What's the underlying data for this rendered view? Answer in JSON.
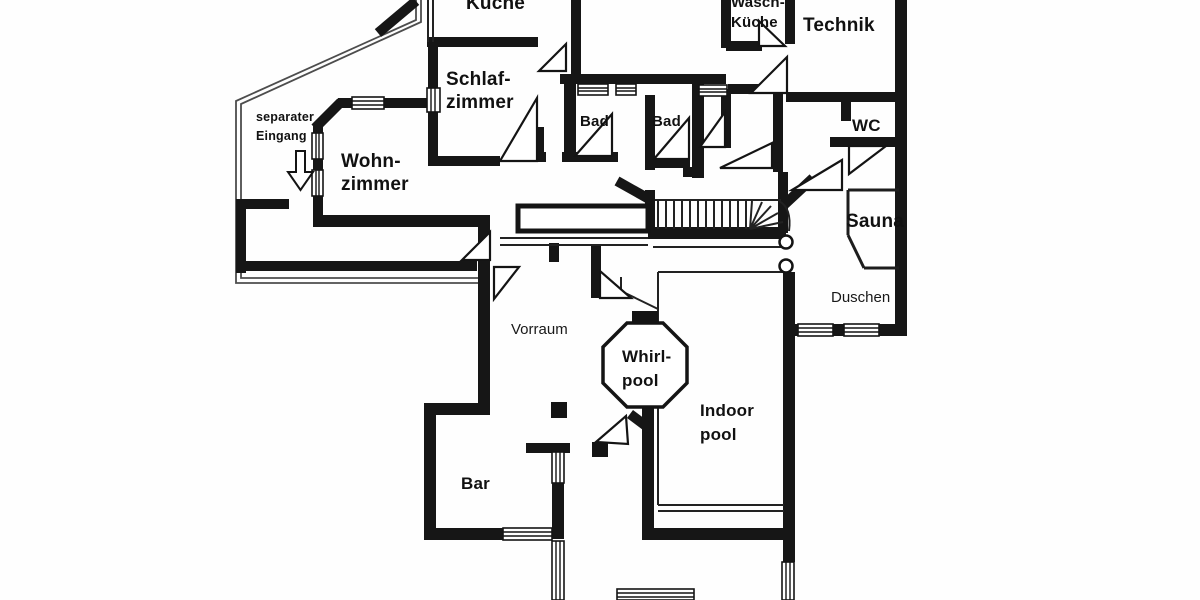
{
  "plan": {
    "type": "floor-plan",
    "colors": {
      "wall": "#161616",
      "background": "#ffffff",
      "boundary": "#4d4d4d",
      "text": "#111111"
    },
    "labels": {
      "kueche": "Küche",
      "schlafzimmer_line1": "Schlaf-",
      "schlafzimmer_line2": "zimmer",
      "waschkueche_line1": "Wasch-",
      "waschkueche_line2": "Küche",
      "technik": "Technik",
      "bad_left": "Bad",
      "bad_right": "Bad",
      "wc": "WC",
      "separater_eingang_line1": "separater",
      "separater_eingang_line2": "Eingang",
      "wohnzimmer_line1": "Wohn-",
      "wohnzimmer_line2": "zimmer",
      "sauna": "Sauna",
      "duschen": "Duschen",
      "vorraum": "Vorraum",
      "whirlpool_line1": "Whirl-",
      "whirlpool_line2": "pool",
      "indoorpool_line1": "Indoor",
      "indoorpool_line2": "pool",
      "bar": "Bar"
    }
  }
}
